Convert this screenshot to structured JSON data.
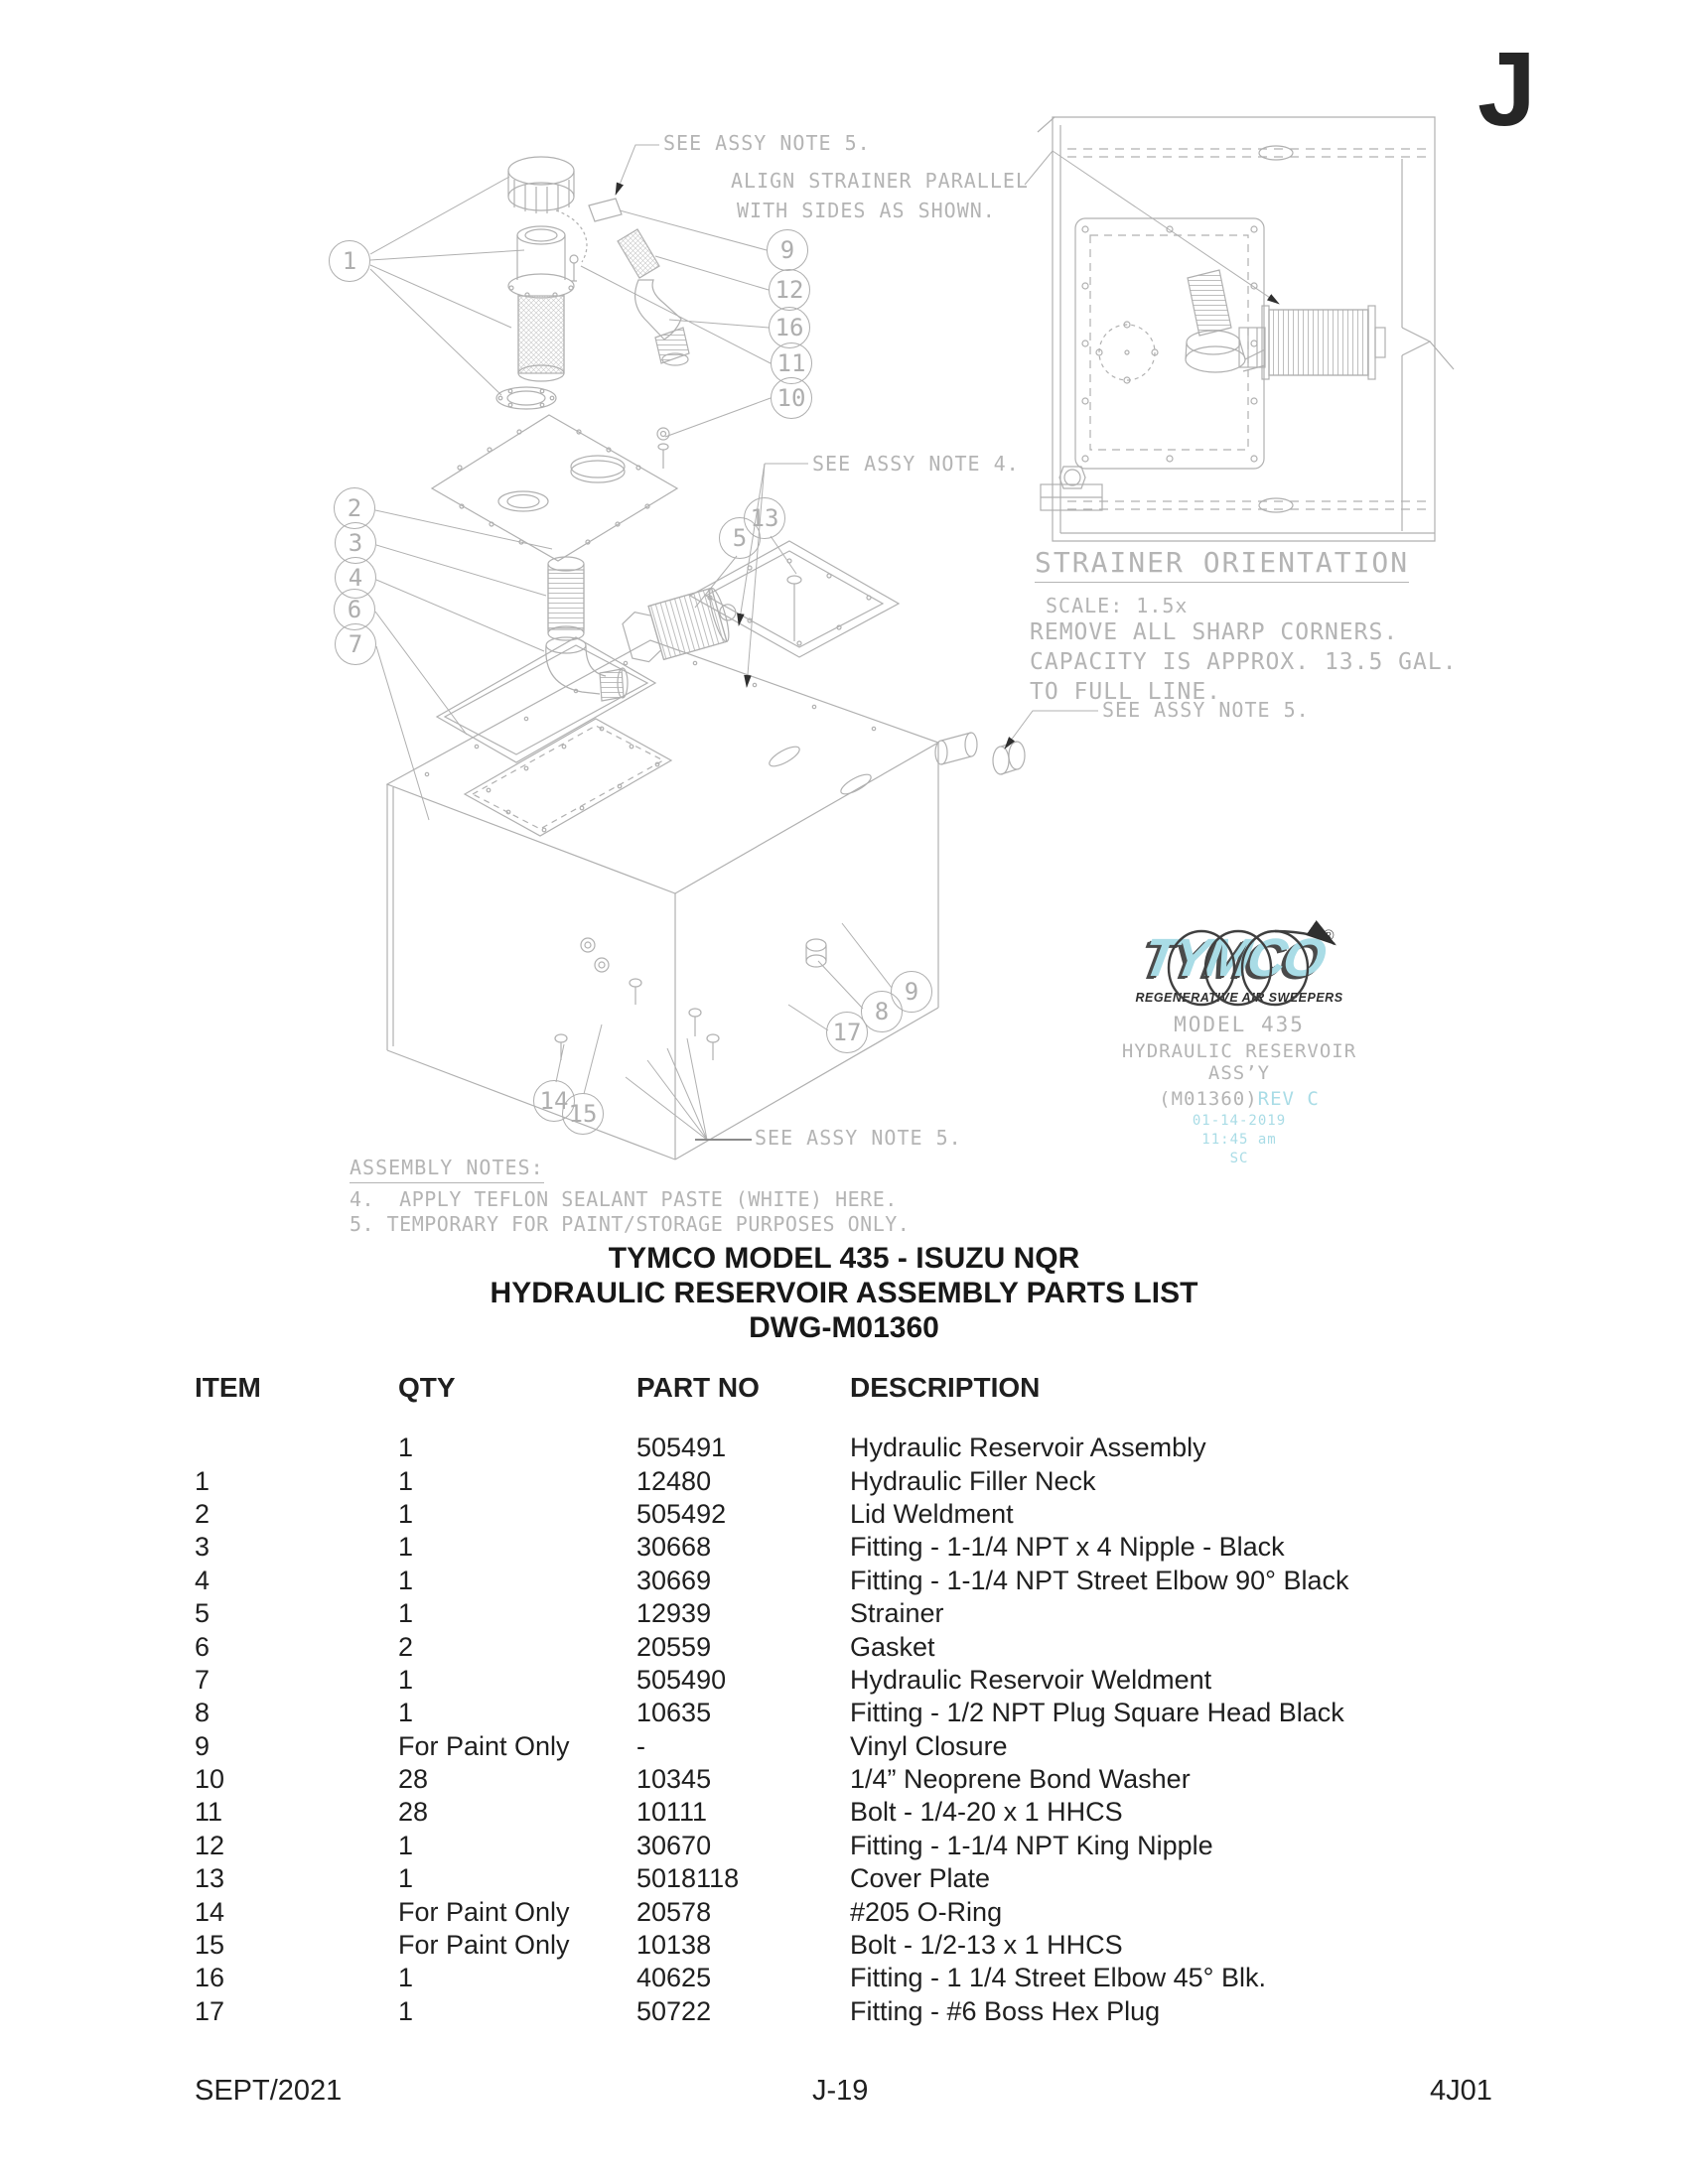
{
  "page": {
    "section_letter": "J",
    "footer": {
      "date": "SEPT/2021",
      "page_no": "J-19",
      "doc_code": "4J01"
    }
  },
  "diagram": {
    "annotations": {
      "see_note_5": "SEE ASSY NOTE 5.",
      "see_note_4": "SEE ASSY NOTE 4.",
      "align_line1": "ALIGN STRAINER PARALLEL",
      "align_line2": "WITH SIDES AS SHOWN."
    },
    "strainer_detail": {
      "title": "STRAINER ORIENTATION",
      "scale": "SCALE: 1.5x",
      "note1": "REMOVE ALL SHARP CORNERS.",
      "note2": "CAPACITY IS APPROX. 13.5 GAL.",
      "note3": "TO FULL LINE."
    },
    "assembly_notes": {
      "heading": "ASSEMBLY NOTES:",
      "note4": "4.  APPLY TEFLON SEALANT PASTE (WHITE) HERE.",
      "note5": "5. TEMPORARY FOR PAINT/STORAGE PURPOSES ONLY."
    },
    "callouts": [
      "1",
      "9",
      "12",
      "16",
      "11",
      "10",
      "2",
      "3",
      "4",
      "6",
      "7",
      "13",
      "5",
      "17",
      "8",
      "9",
      "14",
      "15"
    ],
    "logo": {
      "brand": "TYMCO",
      "registered": "®",
      "tagline": "REGENERATIVE AIR SWEEPERS",
      "model": "MODEL 435",
      "assembly": "HYDRAULIC RESERVOIR ASS’Y",
      "drawing_no": "(M01360)",
      "rev": "REV C",
      "date": "01-14-2019",
      "time": "11:45 am",
      "initials": "SC"
    }
  },
  "title_block": {
    "line1": "TYMCO MODEL 435 - ISUZU NQR",
    "line2": "HYDRAULIC RESERVOIR ASSEMBLY PARTS LIST",
    "line3": "DWG-M01360"
  },
  "parts_table": {
    "headers": [
      "ITEM",
      "QTY",
      "PART NO",
      "DESCRIPTION"
    ],
    "rows": [
      {
        "item": "",
        "qty": "1",
        "part": "505491",
        "desc": "Hydraulic Reservoir Assembly"
      },
      {
        "item": "1",
        "qty": "1",
        "part": "12480",
        "desc": "Hydraulic Filler Neck"
      },
      {
        "item": "2",
        "qty": "1",
        "part": "505492",
        "desc": "Lid Weldment"
      },
      {
        "item": "3",
        "qty": "1",
        "part": "30668",
        "desc": "Fitting - 1-1/4 NPT x 4 Nipple - Black"
      },
      {
        "item": "4",
        "qty": "1",
        "part": "30669",
        "desc": "Fitting - 1-1/4 NPT Street Elbow 90° Black"
      },
      {
        "item": "5",
        "qty": "1",
        "part": "12939",
        "desc": "Strainer"
      },
      {
        "item": "6",
        "qty": "2",
        "part": "20559",
        "desc": "Gasket"
      },
      {
        "item": "7",
        "qty": "1",
        "part": "505490",
        "desc": "Hydraulic Reservoir Weldment"
      },
      {
        "item": "8",
        "qty": "1",
        "part": "10635",
        "desc": "Fitting - 1/2 NPT Plug Square Head Black"
      },
      {
        "item": "9",
        "qty": "For Paint Only",
        "part": "-",
        "desc": "Vinyl Closure"
      },
      {
        "item": "10",
        "qty": "28",
        "part": "10345",
        "desc": "1/4” Neoprene Bond Washer"
      },
      {
        "item": "11",
        "qty": "28",
        "part": "10111",
        "desc": "Bolt - 1/4-20 x 1 HHCS"
      },
      {
        "item": "12",
        "qty": "1",
        "part": "30670",
        "desc": "Fitting - 1-1/4 NPT King Nipple"
      },
      {
        "item": "13",
        "qty": "1",
        "part": "5018118",
        "desc": "Cover Plate"
      },
      {
        "item": "14",
        "qty": "For Paint Only",
        "part": "20578",
        "desc": "#205 O-Ring"
      },
      {
        "item": "15",
        "qty": "For Paint Only",
        "part": "10138",
        "desc": "Bolt - 1/2-13 x 1 HHCS"
      },
      {
        "item": "16",
        "qty": "1",
        "part": "40625",
        "desc": "Fitting - 1 1/4 Street Elbow 45° Blk."
      },
      {
        "item": "17",
        "qty": "1",
        "part": "50722",
        "desc": "Fitting - #6 Boss Hex Plug"
      }
    ]
  },
  "colors": {
    "cad_line": "#b0b0b0",
    "cad_text": "#b4b4b4",
    "accent_cyan": "#a9dce6",
    "ink": "#1f1f1f",
    "arrow": "#2f2f2f"
  }
}
